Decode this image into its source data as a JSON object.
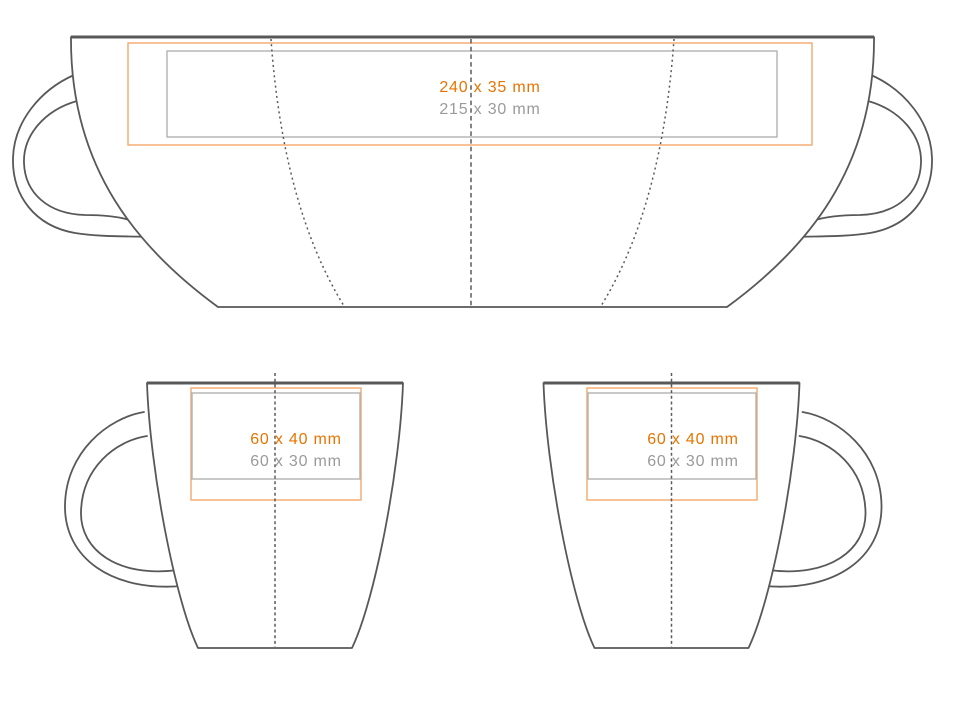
{
  "colors": {
    "outline": "#58585a",
    "guide": "#5a5a5c",
    "orange-text": "#e87301",
    "gray-text": "#9a9a9a",
    "orange-border": "#f4a96c",
    "gray-border": "#b2b2b4"
  },
  "views": {
    "wrap": {
      "size_orange": "240 x 35 mm",
      "size_gray": "215 x 30 mm"
    },
    "mug_left": {
      "size_orange": "60 x 40 mm",
      "size_gray": "60 x 30 mm"
    },
    "mug_right": {
      "size_orange": "60 x 40 mm",
      "size_gray": "60 x 30 mm"
    }
  }
}
